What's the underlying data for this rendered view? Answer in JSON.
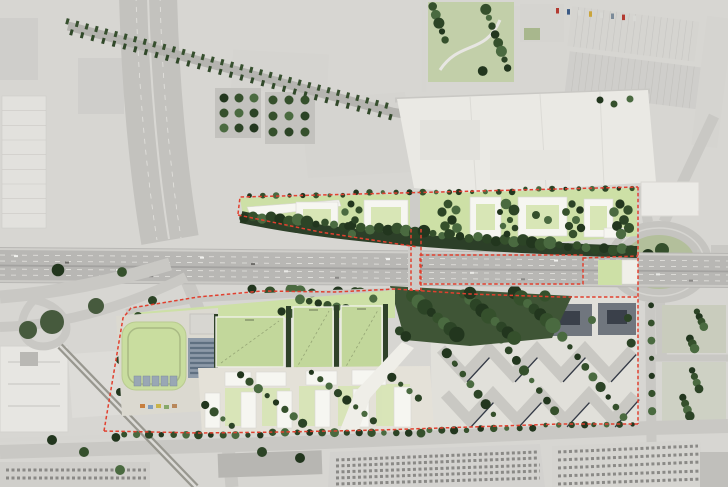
{
  "meta": {
    "title": "Aerial masterplan rendering over grayscale orthophoto",
    "width_px": 728,
    "height_px": 487,
    "visible_text": "none (pitch dimension labels illegible at this scale)"
  },
  "palette": {
    "aerial": "#d7d6d2",
    "asphalt": "#b8b7b4",
    "road": "#c9c8c4",
    "lawn": "#cde0a6",
    "pitch": "#c2d79b",
    "field": "#c9dd9f",
    "courtyard": "#d8e6b6",
    "building": "#f6f6f1",
    "woodland": "#3f5536",
    "tree_dark": "#22361e",
    "solar": "#8d9aa8",
    "solar_stripe": "#5f7081",
    "estate_block": "#c9c8c3",
    "estate_shadow": "#343a46",
    "estate_dark_roof": "#70767e",
    "boundary": "#e1402f",
    "parking": "#d3d2cf"
  },
  "site": {
    "boundary_style": "red dashed outline around both development parcels and along motorway segment",
    "upper_parcel": {
      "courtyard_blocks": 5,
      "linear_building": 1,
      "tree_buffer_along_motorway": true,
      "street_tree_row_along_north_edge": true
    },
    "motorway": {
      "orientation": "horizontal across centre",
      "marked_segments_dashed_red": 1,
      "crossing_link_dashed_red": 1
    },
    "lower_parcel": {
      "sports_pitches": 3,
      "athletics_field": 1,
      "solar_roof_building": 1,
      "housing_slab_row_buildings": 10,
      "woodland_grove": 1,
      "white_promenade": 1,
      "street_tree_row_along_south_edge": true
    },
    "existing_estate": {
      "pattern": "zigzag apartment blocks",
      "zigzag_rows": 2,
      "dark_perimeter_blocks": 3
    },
    "context": {
      "roundabout_with_green_centre": 1,
      "rail_corridor_diagonal_top_left": 1,
      "elevated_viaduct_bottom_left": 1,
      "large_parking_lots_bottom": 2,
      "industrial_roofs_top": true,
      "park_top_centre": 1
    }
  }
}
